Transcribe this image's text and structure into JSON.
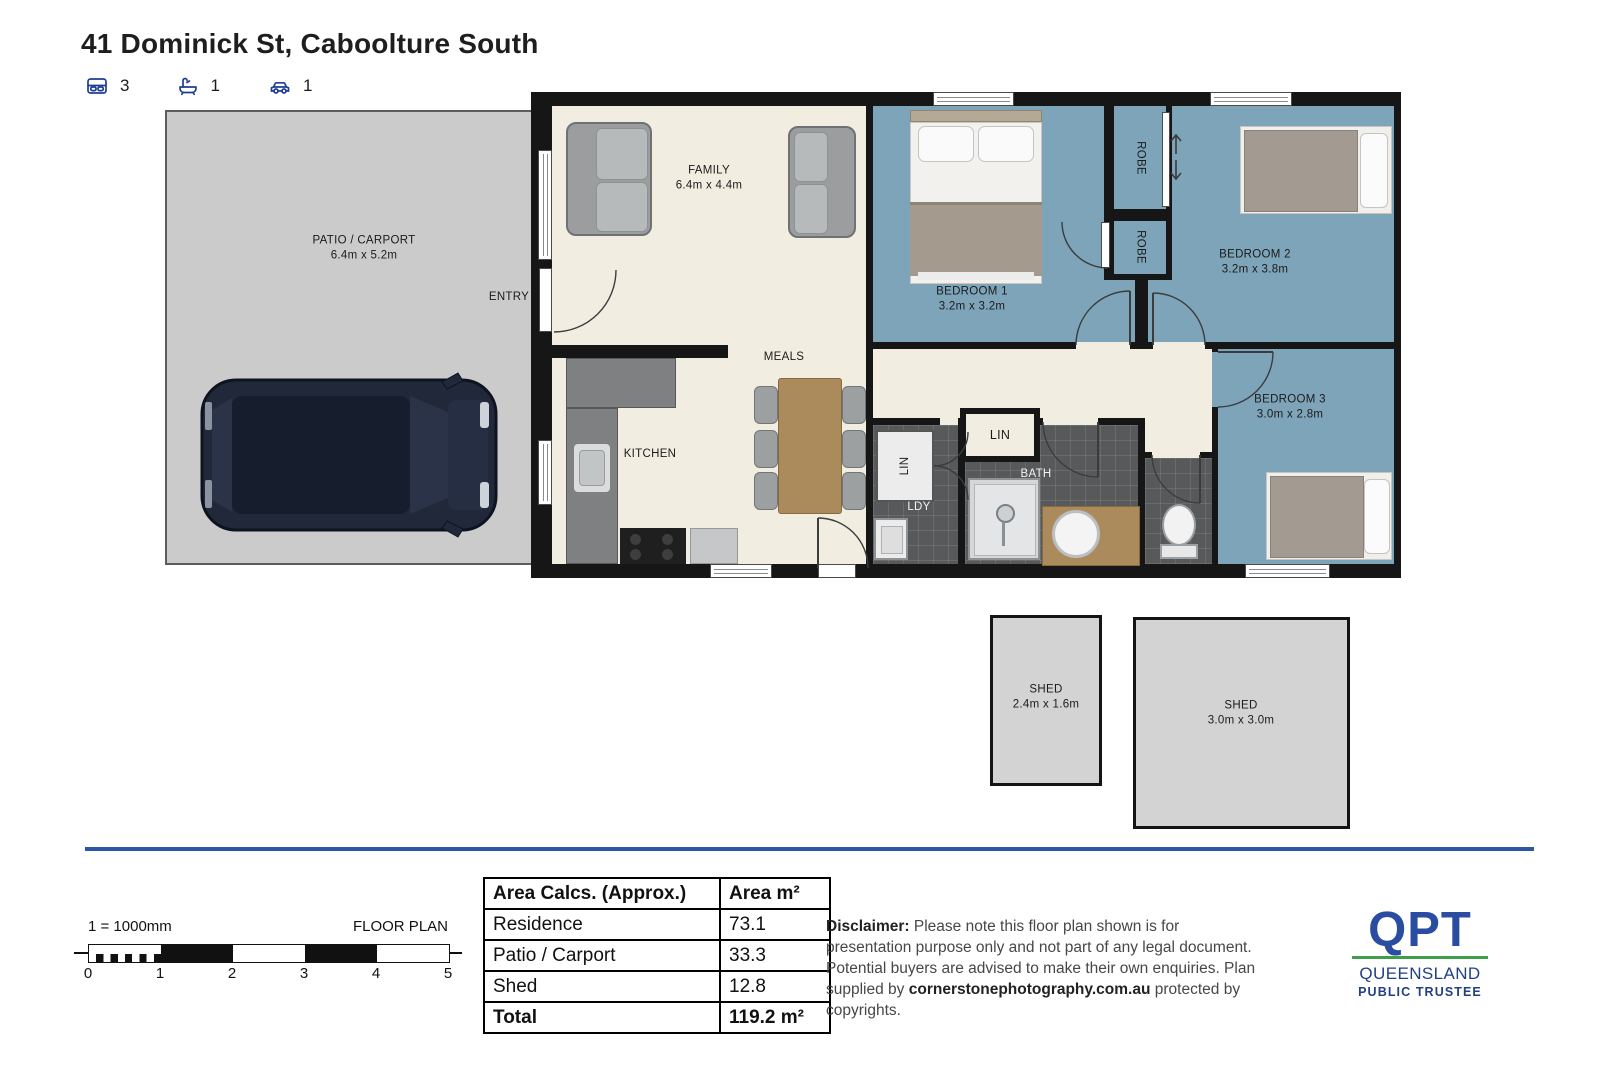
{
  "header": {
    "title": "41 Dominick St, Caboolture South",
    "bedrooms": "3",
    "bathrooms": "1",
    "cars": "1"
  },
  "floorplan": {
    "patio": {
      "name": "PATIO / CARPORT",
      "dims": "6.4m x 5.2m"
    },
    "entry": {
      "name": "ENTRY"
    },
    "family": {
      "name": "FAMILY",
      "dims": "6.4m x 4.4m"
    },
    "meals": {
      "name": "MEALS"
    },
    "kitchen": {
      "name": "KITCHEN"
    },
    "bedroom1": {
      "name": "BEDROOM 1",
      "dims": "3.2m x 3.2m"
    },
    "bedroom2": {
      "name": "BEDROOM 2",
      "dims": "3.2m x 3.8m"
    },
    "bedroom3": {
      "name": "BEDROOM 3",
      "dims": "3.0m x 2.8m"
    },
    "robe1": {
      "name": "ROBE"
    },
    "robe2": {
      "name": "ROBE"
    },
    "linen_hall": {
      "name": "LIN"
    },
    "linen_ldy": {
      "name": "LIN"
    },
    "laundry": {
      "name": "LDY"
    },
    "bath": {
      "name": "BATH"
    },
    "shed1": {
      "name": "SHED",
      "dims": "2.4m x 1.6m"
    },
    "shed2": {
      "name": "SHED",
      "dims": "3.0m x 3.0m"
    }
  },
  "scale_bar": {
    "ratio": "1 = 1000mm",
    "caption": "FLOOR PLAN",
    "ticks": [
      "0",
      "1",
      "2",
      "3",
      "4",
      "5"
    ]
  },
  "area_table": {
    "header": {
      "label": "Area Calcs. (Approx.)",
      "unit": "Area m²"
    },
    "rows": [
      {
        "label": "Residence",
        "value": "73.1"
      },
      {
        "label": "Patio / Carport",
        "value": "33.3"
      },
      {
        "label": "Shed",
        "value": "12.8"
      }
    ],
    "total": {
      "label": "Total",
      "value": "119.2 m²"
    }
  },
  "disclaimer": {
    "heading": "Disclaimer:",
    "body": " Please note this floor plan shown is for presentation purpose only and not part of any legal document. Potential buyers are advised to make their own enquiries. Plan supplied by ",
    "source": "cornerstonephotography.com.au",
    "suffix": " protected by copyrights."
  },
  "logo": {
    "acronym": "QPT",
    "region": "QUEENSLAND",
    "org": "PUBLIC TRUSTEE"
  },
  "colors": {
    "accent_navy": "#1d3e94",
    "floor_blue": "#7da4b8",
    "floor_cream": "#f1eee1",
    "tile_gray": "#58595b",
    "divider_blue": "#2d56a5",
    "logo_blue": "#2b4da1",
    "logo_green": "#3f9e49"
  }
}
